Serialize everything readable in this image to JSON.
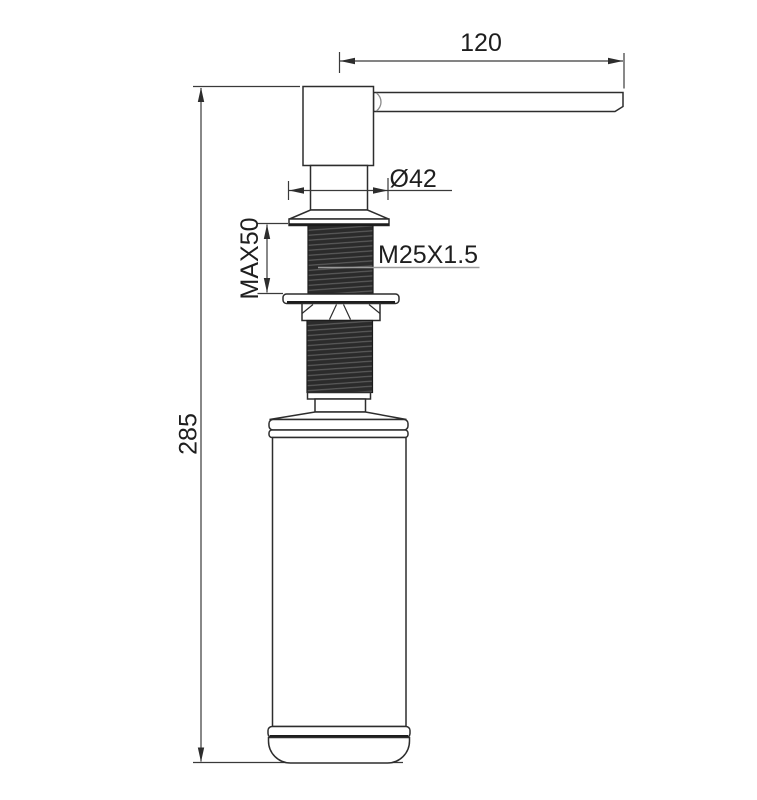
{
  "drawing": {
    "labels": {
      "spout_length": "120",
      "overall_height": "285",
      "flange_diameter": "Ø42",
      "max_mounting_thickness": "MAX50",
      "thread_spec": "M25X1.5"
    },
    "colors": {
      "outline": "#2d2d2d",
      "dimension_line": "#3a3a3a",
      "leader_line": "#9a9a9a",
      "thread_fill": "#2b2b2b",
      "text": "#1e1e1e",
      "background": "#ffffff"
    }
  }
}
